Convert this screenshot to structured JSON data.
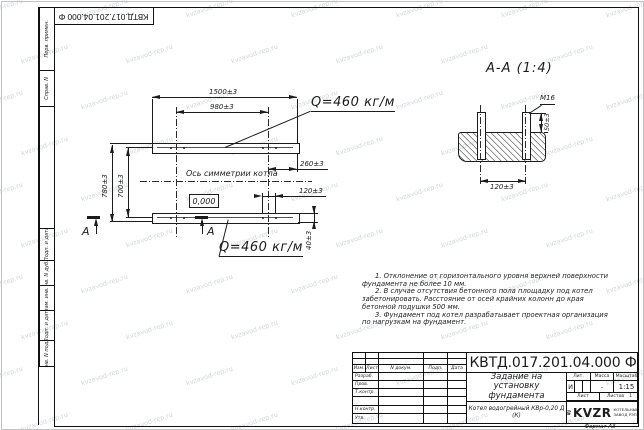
{
  "watermark": {
    "text": "kvzavod-rep.ru"
  },
  "frame": {
    "left_strip": [
      "Перв. примен.",
      "Справ. N",
      "Подп. и дата",
      "Инв. N дубл.",
      "Взам. инв. N",
      "Подп. и дата",
      "Инв. N подл."
    ]
  },
  "plan": {
    "dim_length_total": "1500±3",
    "dim_length_bolts": "980±3",
    "dim_width_total": "780±3",
    "dim_width_bolts": "700±3",
    "dim_offset_right": "260±3",
    "dim_bolt_pitch": "120±3",
    "dim_beam_height": "40±3",
    "level_mark": "0,000",
    "load_label": "Q=460 кг/м",
    "axis_label": "Ось симметрии котла",
    "section_letter": "А"
  },
  "section": {
    "title": "А-А (1:4)",
    "bolt_thread": "М16",
    "dim_bolt_height": "50±3",
    "dim_bolt_pitch": "120±3"
  },
  "notes": {
    "items": [
      "1. Отклонение от горизонтального уровня верхней поверхности фундамента не более 10 мм.",
      "2. В случае отсутствия бетонного пола площадку под котел забетонировать. Расстояние от осей крайних колонн до края бетонной подушки 500 мм.",
      "3. Фундамент под котел разрабатывает проектная организация по нагрузкам на фундамент."
    ]
  },
  "titleblock": {
    "designation": "КВТД.017.201.04.000 Ф",
    "doc_title_lines": [
      "Задание на",
      "установку",
      "фундамента"
    ],
    "product": "Котел водогрейный КВр-0,20 Д (К)",
    "header": {
      "izm": "Изм.",
      "list": "Лист",
      "ndoc": "N докум.",
      "podp": "Подп.",
      "data": "Дата"
    },
    "rows": [
      "Разраб.",
      "Пров.",
      "Т.контр.",
      "",
      "Н.контр.",
      "Утв."
    ],
    "lit_header": "Лит.",
    "mass_header": "Масса",
    "scale_header": "Масштаб",
    "lit_value": "И",
    "mass_value": "-",
    "scale_value": "1:15",
    "sheet_label": "Лист",
    "sheets_label": "Листов",
    "sheets_value": "1",
    "logo_text": "KVZR",
    "logo_sub1": "КОТЕЛЬНЫЙ",
    "logo_sub2": "ЗАВОД РЭП",
    "format_label": "Формат А3"
  }
}
